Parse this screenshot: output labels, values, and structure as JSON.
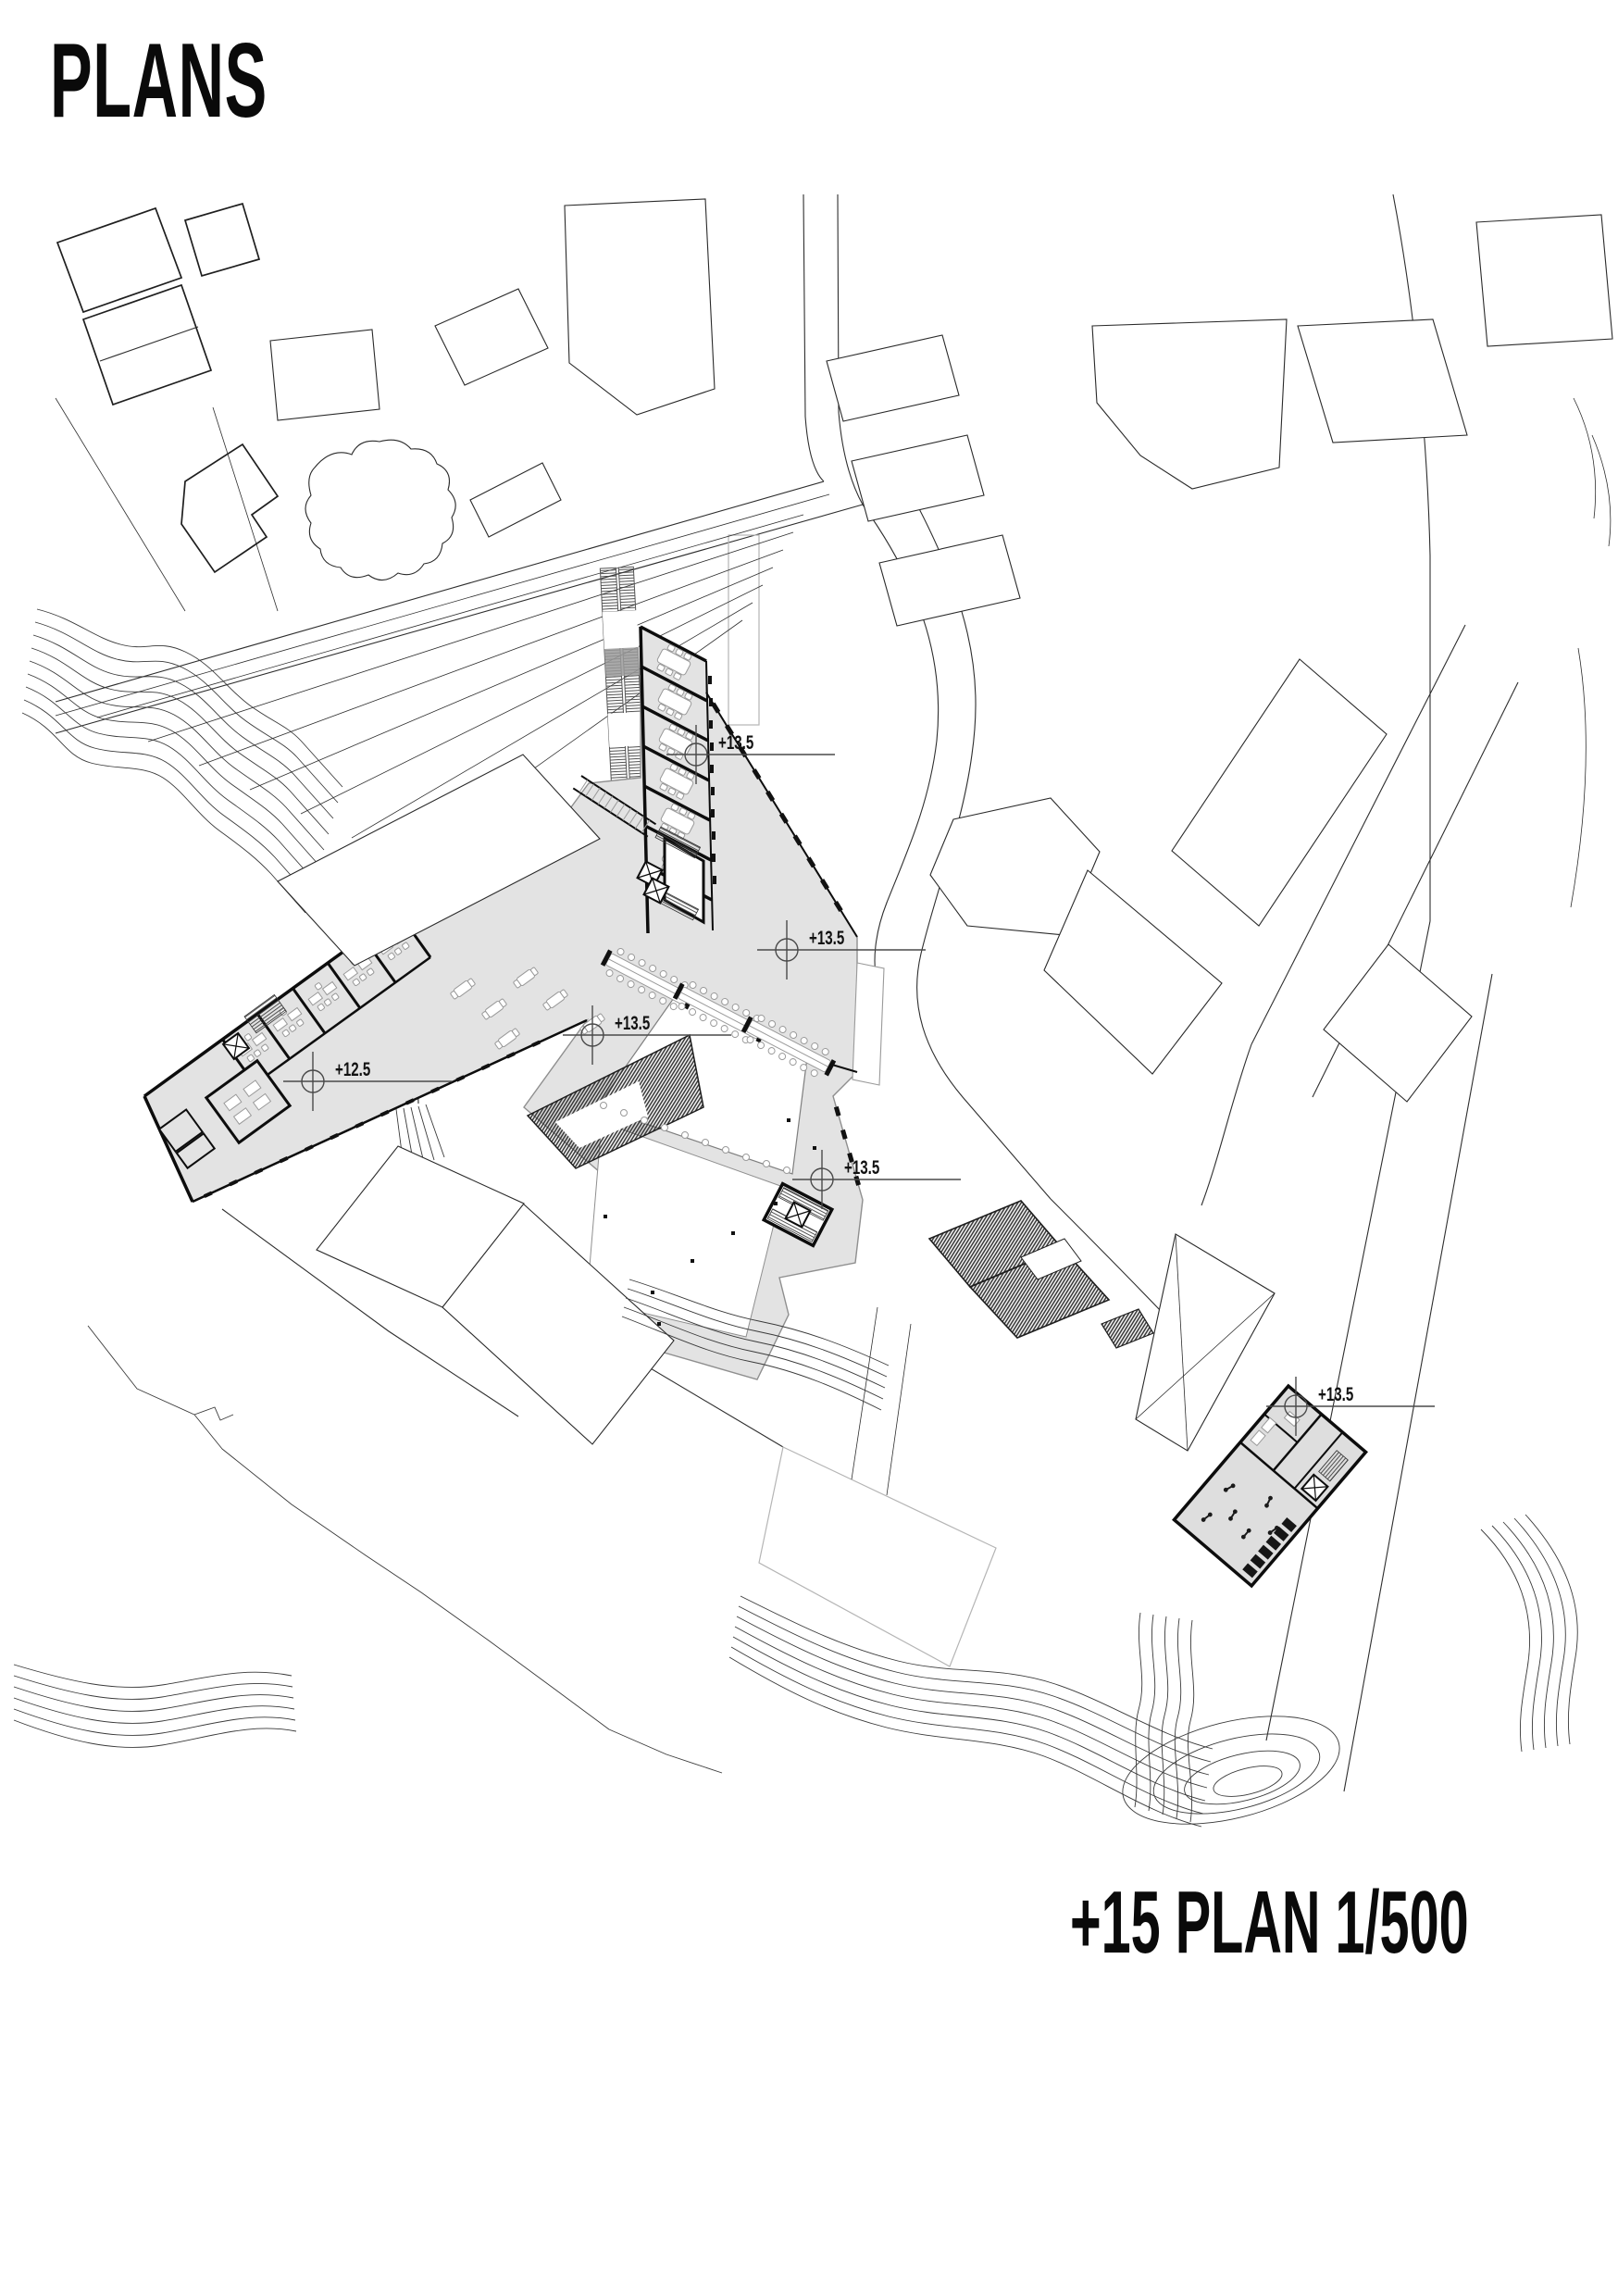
{
  "page": {
    "title": "PLANS",
    "caption": "+15 PLAN 1/500"
  },
  "drawing": {
    "type": "architectural-site-plan",
    "plan_level": "+15",
    "scale": "1/500",
    "level_markers": [
      {
        "label": "+13.5"
      },
      {
        "label": "+13.5"
      },
      {
        "label": "+13.5"
      },
      {
        "label": "+12.5"
      },
      {
        "label": "+13.5"
      },
      {
        "label": "+13.5"
      }
    ],
    "colors": {
      "paper": "#ffffff",
      "line": "#1f1f1f",
      "building_fill": "#e3e3e3",
      "light_line": "#b5b5b5"
    }
  }
}
